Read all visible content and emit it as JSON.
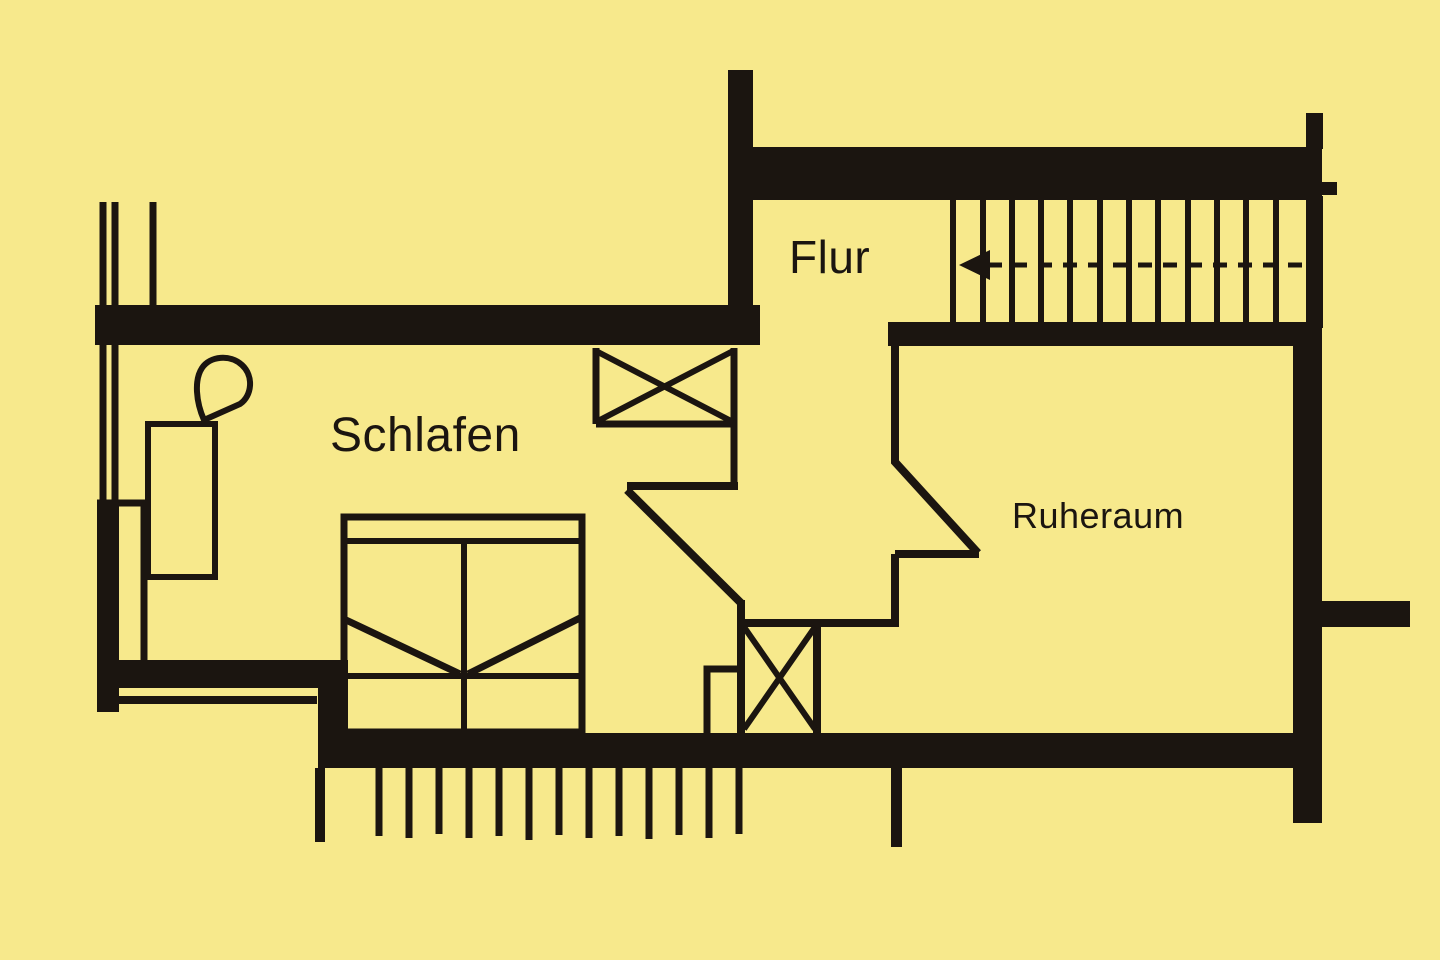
{
  "document": {
    "type": "floor-plan"
  },
  "colors": {
    "background": "#f7e98c",
    "line": "#1b1510",
    "text": "#1b1510"
  },
  "rooms": [
    {
      "id": "schlafen",
      "label": "Schlafen"
    },
    {
      "id": "flur",
      "label": "Flur"
    },
    {
      "id": "ruheraum",
      "label": "Ruheraum"
    }
  ],
  "symbols": [
    {
      "id": "staircase-icon",
      "meaning": "stair treads with dashed walking line and direction arrow"
    },
    {
      "id": "bed-icon",
      "meaning": "double bed"
    },
    {
      "id": "wash-basin-icon",
      "meaning": "wash basin with cabinet"
    },
    {
      "id": "crossed-box-icon",
      "meaning": "window / shaft symbol with X"
    },
    {
      "id": "railing-hatch-icon",
      "meaning": "balcony railing hatch marks"
    }
  ]
}
